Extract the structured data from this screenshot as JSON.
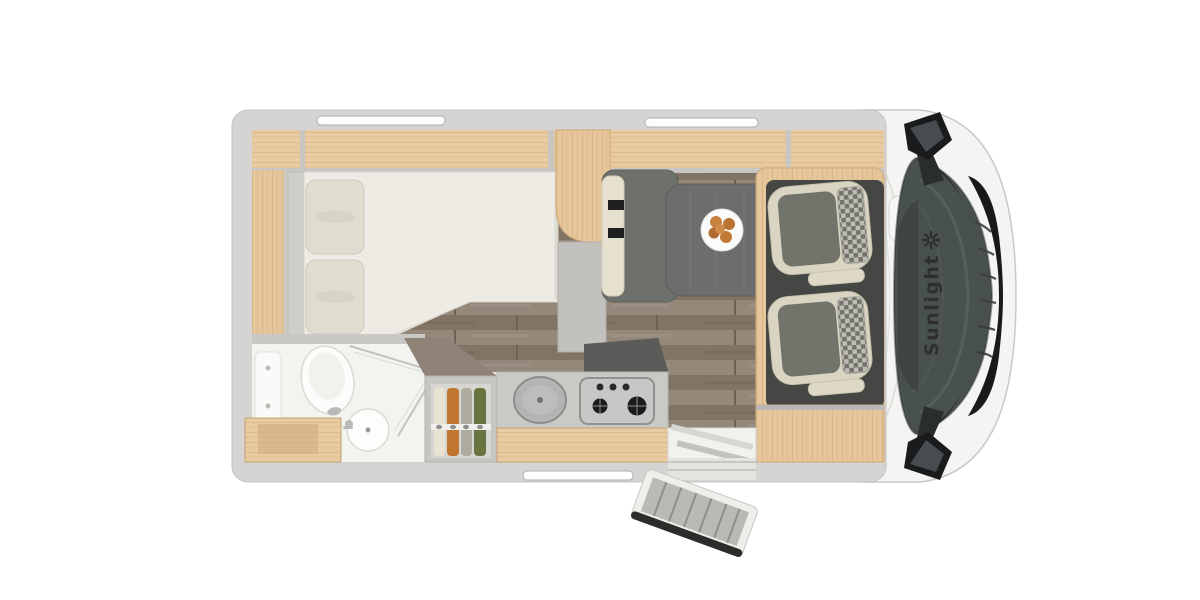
{
  "brand": {
    "logo_text": "Sunlight",
    "logo_icon": "sun-icon",
    "text_color": "#2f2f2d"
  },
  "palette": {
    "background": "#ffffff",
    "outer_wall_gray": "#d5d4d2",
    "light_wood": "#e6c69b",
    "floor_wood": "#8c7f70",
    "mattress": "#edebe4",
    "pillow": "#dfdcd0",
    "table_gray": "#6b6e6c",
    "bench_gray": "#6e706c",
    "seat_cream": "#d9d5c2",
    "seat_gray": "#72746c",
    "cab_floor_dark": "#454744",
    "windshield": "#49514c",
    "grille_black": "#17191b",
    "clothes_orange": "#c1762f",
    "clothes_green": "#67743f",
    "food_orange": "#c6813d"
  },
  "floorplan": {
    "view": "motorhome-top-view",
    "areas": [
      {
        "name": "rear-bedroom",
        "features": [
          "double-bed",
          "pillows",
          "overhead-lockers",
          "side-cabinet"
        ]
      },
      {
        "name": "bathroom",
        "features": [
          "toilet",
          "washbasin",
          "faucet",
          "shower-glass",
          "vanity-cabinet",
          "shower-panel"
        ]
      },
      {
        "name": "wardrobe",
        "features": [
          "clothes-rail",
          "hanging-clothes-4"
        ]
      },
      {
        "name": "kitchen",
        "features": [
          "round-sink",
          "gas-hob-3-burner",
          "counter-front",
          "dark-worktop"
        ]
      },
      {
        "name": "dinette",
        "features": [
          "table",
          "plate-of-food",
          "belted-bench-seat"
        ]
      },
      {
        "name": "cab",
        "features": [
          "driver-seat",
          "passenger-seat",
          "windshield",
          "side-mirror-top",
          "side-mirror-bottom",
          "front-grille"
        ]
      },
      {
        "name": "entrance",
        "features": [
          "entry-step",
          "open-entry-door",
          "threshold"
        ]
      }
    ],
    "window_slots": 3,
    "plate_food_items": 5
  }
}
